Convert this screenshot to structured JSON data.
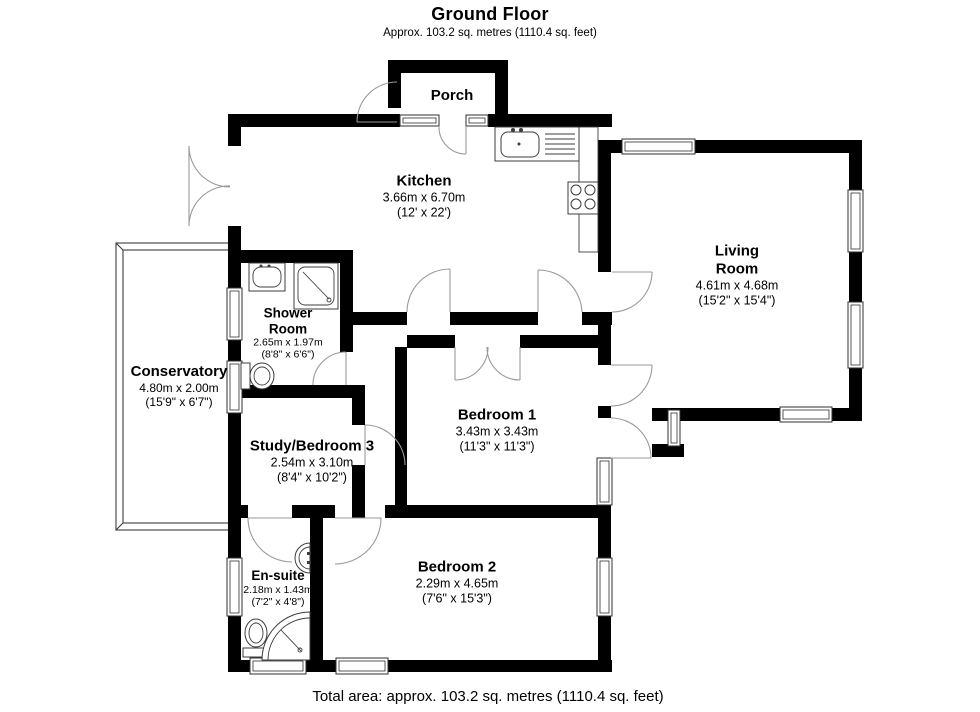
{
  "header": {
    "title": "Ground Floor",
    "subtitle": "Approx. 103.2 sq. metres (1110.4 sq. feet)"
  },
  "footer": {
    "total_area": "Total area: approx. 103.2 sq. metres (1110.4 sq. feet)"
  },
  "rooms": {
    "porch": {
      "name": "Porch"
    },
    "kitchen": {
      "name": "Kitchen",
      "metric": "3.66m x 6.70m",
      "imperial": "(12' x 22')"
    },
    "living": {
      "name": "Living Room",
      "metric": "4.61m x 4.68m",
      "imperial": "(15'2\" x 15'4\")"
    },
    "shower": {
      "name": "Shower Room",
      "metric": "2.65m x 1.97m",
      "imperial": "(8'8\" x 6'6\")"
    },
    "conservatory": {
      "name": "Conservatory",
      "metric": "4.80m x 2.00m",
      "imperial": "(15'9\" x 6'7\")"
    },
    "study": {
      "name": "Study/Bedroom 3",
      "metric": "2.54m x 3.10m",
      "imperial": "(8'4\" x 10'2\")"
    },
    "bedroom1": {
      "name": "Bedroom 1",
      "metric": "3.43m x 3.43m",
      "imperial": "(11'3\" x 11'3\")"
    },
    "bedroom2": {
      "name": "Bedroom 2",
      "metric": "2.29m x 4.65m",
      "imperial": "(7'6\" x 15'3\")"
    },
    "ensuite": {
      "name": "En-suite",
      "metric": "2.18m x 1.43m",
      "imperial": "(7'2\" x 4'8\")"
    }
  },
  "colors": {
    "wall": "#000000",
    "fixture_line": "#3c3c3c",
    "door_arc": "#9a9a9a",
    "background": "#ffffff"
  }
}
